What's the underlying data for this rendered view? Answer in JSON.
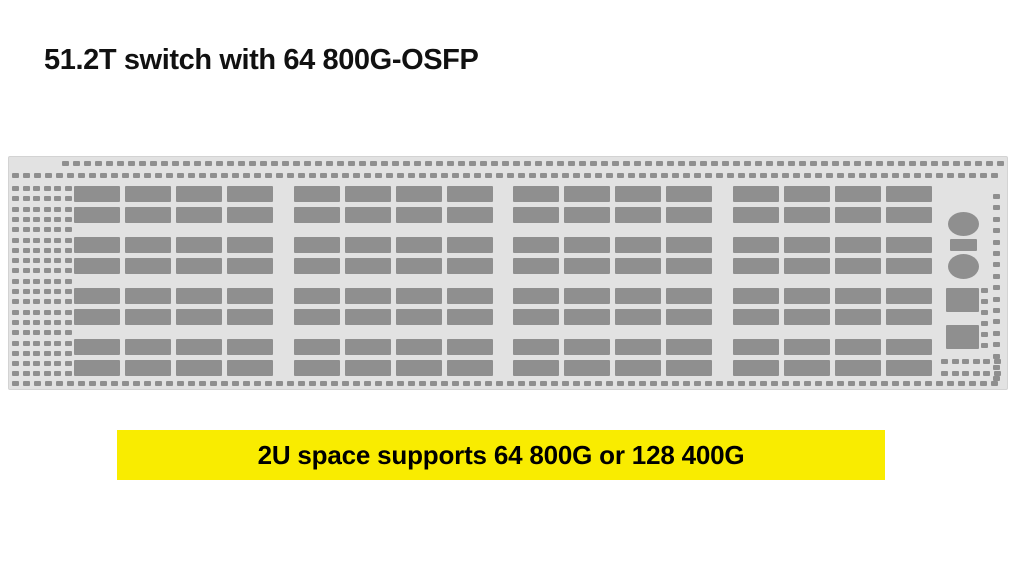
{
  "title": "51.2T switch with 64 800G-OSFP",
  "banner": {
    "text": "2U space supports 64 800G or 128 400G",
    "bg_color": "#F9EC00",
    "text_color": "#000000"
  },
  "switch": {
    "description": "2U switch front faceplate illustration",
    "faceplate_color": "#E2E2E2",
    "port_color": "#8F8F8F",
    "port_banks": 4,
    "port_rows": 8,
    "ports_per_bank_row": 4,
    "total_port_cages": 128,
    "controls": [
      "round-connector-top",
      "indicator-bar",
      "round-connector-bottom",
      "mgmt-port-upper",
      "mgmt-port-lower"
    ]
  }
}
